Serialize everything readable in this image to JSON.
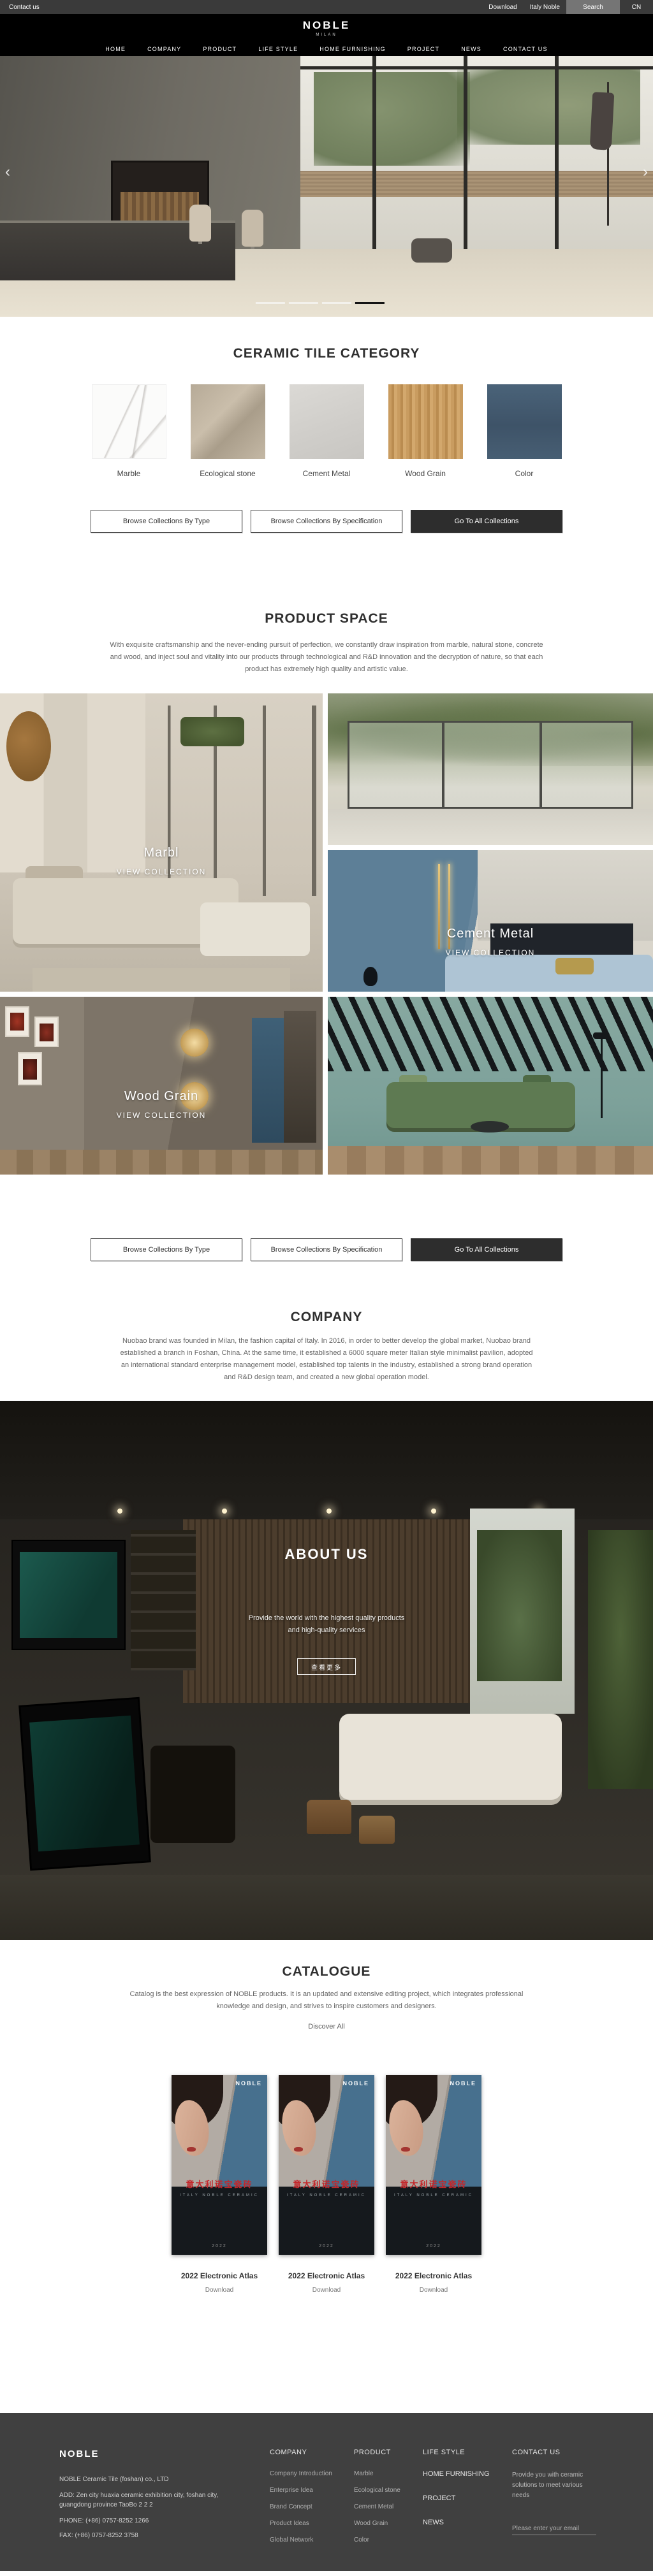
{
  "colors": {
    "topbar_bg": "#3a3a3a",
    "header_bg": "#000000",
    "dark_button_bg": "#2d2d2d",
    "catalogue_red": "#c3272b",
    "footer_bg": "#404040",
    "carousel_active": "#141414"
  },
  "topbar": {
    "contact": "Contact us",
    "download": "Download",
    "italy": "Italy Noble",
    "search": "Search",
    "lang": "CN"
  },
  "header": {
    "logo": "NOBLE",
    "logo_sub": "MILAN",
    "nav": [
      "HOME",
      "COMPANY",
      "PRODUCT",
      "LIFE STYLE",
      "HOME FURNISHING",
      "PROJECT",
      "NEWS",
      "CONTACT US"
    ]
  },
  "hero": {
    "prev": "‹",
    "next": "›",
    "slides_total": 4,
    "active_slide": 4
  },
  "collections_buttons": {
    "by_type": "Browse Collections By Type",
    "by_spec": "Browse Collections By Specification",
    "all": "Go To All Collections"
  },
  "category": {
    "title": "CERAMIC TILE CATEGORY",
    "items": [
      {
        "label": "Marble"
      },
      {
        "label": "Ecological stone"
      },
      {
        "label": "Cement Metal"
      },
      {
        "label": "Wood Grain"
      },
      {
        "label": "Color"
      }
    ]
  },
  "product_space": {
    "title": "PRODUCT SPACE",
    "description": "With exquisite craftsmanship and the never-ending pursuit of perfection, we constantly draw inspiration from marble, natural stone, concrete and wood, and inject soul and vitality into our products through technological and R&D innovation and the decryption of nature, so that each product has extremely high quality and artistic value.",
    "tiles": [
      {
        "name": "Marbl",
        "cta": "VIEW COLLECTION"
      },
      {
        "name": "Cement Metal",
        "cta": "VIEW COLLECTION"
      },
      {
        "name": "Wood Grain",
        "cta": "VIEW COLLECTION"
      }
    ]
  },
  "company": {
    "title": "COMPANY",
    "description": "Nuobao brand was founded in Milan, the fashion capital of Italy. In 2016, in order to better develop the global market, Nuobao brand established a branch in Foshan, China. At the same time, it established a 6000 square meter Italian style minimalist pavilion, adopted an international standard enterprise management model, established top talents in the industry, established a strong brand operation and R&D design team, and created a new global operation model."
  },
  "about": {
    "title": "ABOUT US",
    "text_line1": "Provide the world with the highest quality products",
    "text_line2": "and high-quality services",
    "more_button": "查看更多"
  },
  "catalogue": {
    "title": "CATALOGUE",
    "description": "Catalog is the best expression of NOBLE products. It is an updated and extensive editing project, which integrates professional knowledge and design, and strives to inspire customers and designers.",
    "discover": "Discover All",
    "items": [
      {
        "brand": "NOBLE",
        "title_cn": "意大利诺宝瓷砖",
        "sub": "ITALY NOBLE CERAMIC",
        "caption": "2022",
        "label": "2022 Electronic Atlas",
        "download": "Download"
      },
      {
        "brand": "NOBLE",
        "title_cn": "意大利诺宝瓷砖",
        "sub": "ITALY NOBLE CERAMIC",
        "caption": "2022",
        "label": "2022 Electronic Atlas",
        "download": "Download"
      },
      {
        "brand": "NOBLE",
        "title_cn": "意大利诺宝瓷砖",
        "sub": "ITALY NOBLE CERAMIC",
        "caption": "2022",
        "label": "2022 Electronic Atlas",
        "download": "Download"
      }
    ]
  },
  "footer": {
    "brand": "NOBLE",
    "company_line": "NOBLE Ceramic Tile (foshan) co., LTD",
    "address": "ADD:  Zen city huaxia ceramic exhibition city, foshan city, guangdong province TaoBo 2 2 2",
    "phone": "PHONE:   (+86)  0757-8252 1266",
    "fax": "FAX:   (+86)  0757-8252 3758",
    "col_company": {
      "title": "COMPANY",
      "links": [
        "Company Introduction",
        "Enterprise Idea",
        "Brand Concept",
        "Product Ideas",
        "Global Network"
      ]
    },
    "col_product": {
      "title": "PRODUCT",
      "links": [
        "Marble",
        "Ecological stone",
        "Cement Metal",
        "Wood Grain",
        "Color"
      ]
    },
    "col_life": {
      "title": "LIFE STYLE",
      "links": [
        "HOME FURNISHING",
        "PROJECT",
        "NEWS"
      ]
    },
    "col_contact": {
      "title": "CONTACT US",
      "text": "Provide you with ceramic solutions to meet various needs",
      "email_placeholder": "Please enter your email"
    }
  }
}
